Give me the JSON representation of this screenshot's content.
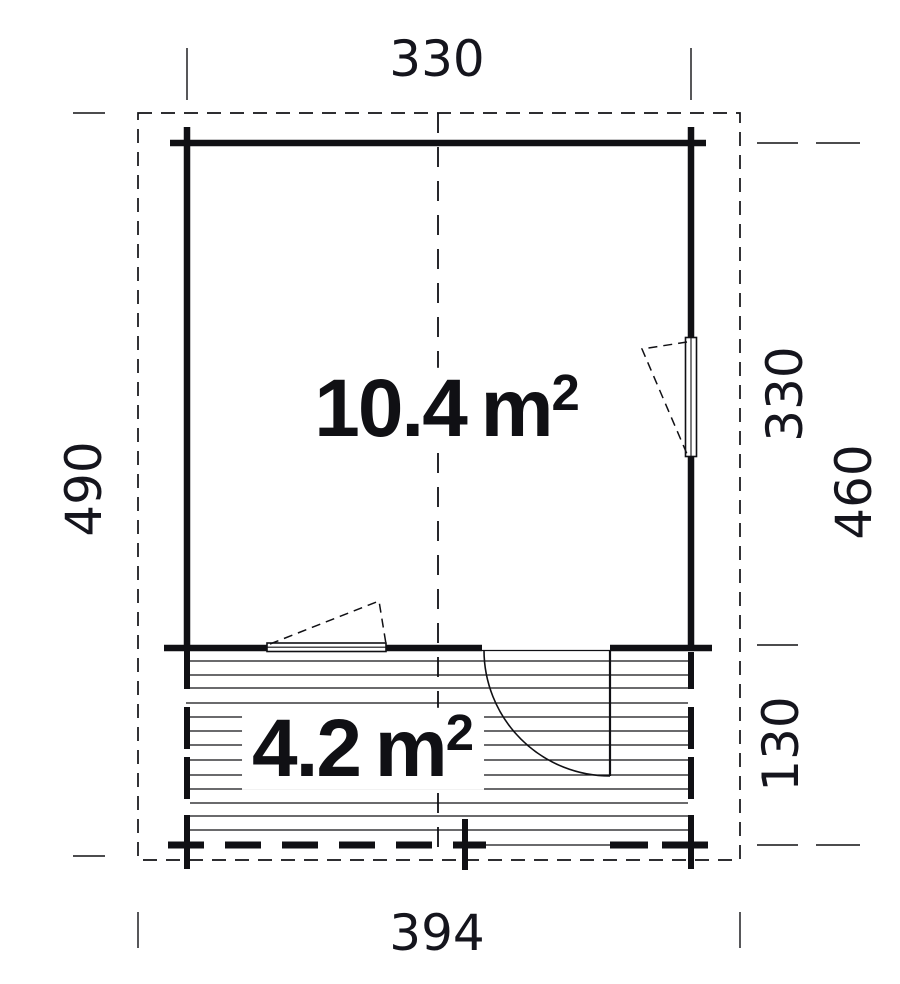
{
  "plan": {
    "dimensions": {
      "top_width": "330",
      "bottom_width": "394",
      "left_height": "490",
      "right_room_depth": "330",
      "right_total_depth": "460",
      "right_terrace_depth": "130"
    },
    "areas": {
      "main_room": {
        "value": "10.4",
        "unit": "m",
        "sup": "2"
      },
      "terrace": {
        "value": "4.2",
        "unit": "m",
        "sup": "2"
      }
    },
    "colors": {
      "line": "#101014",
      "background": "#ffffff"
    }
  }
}
